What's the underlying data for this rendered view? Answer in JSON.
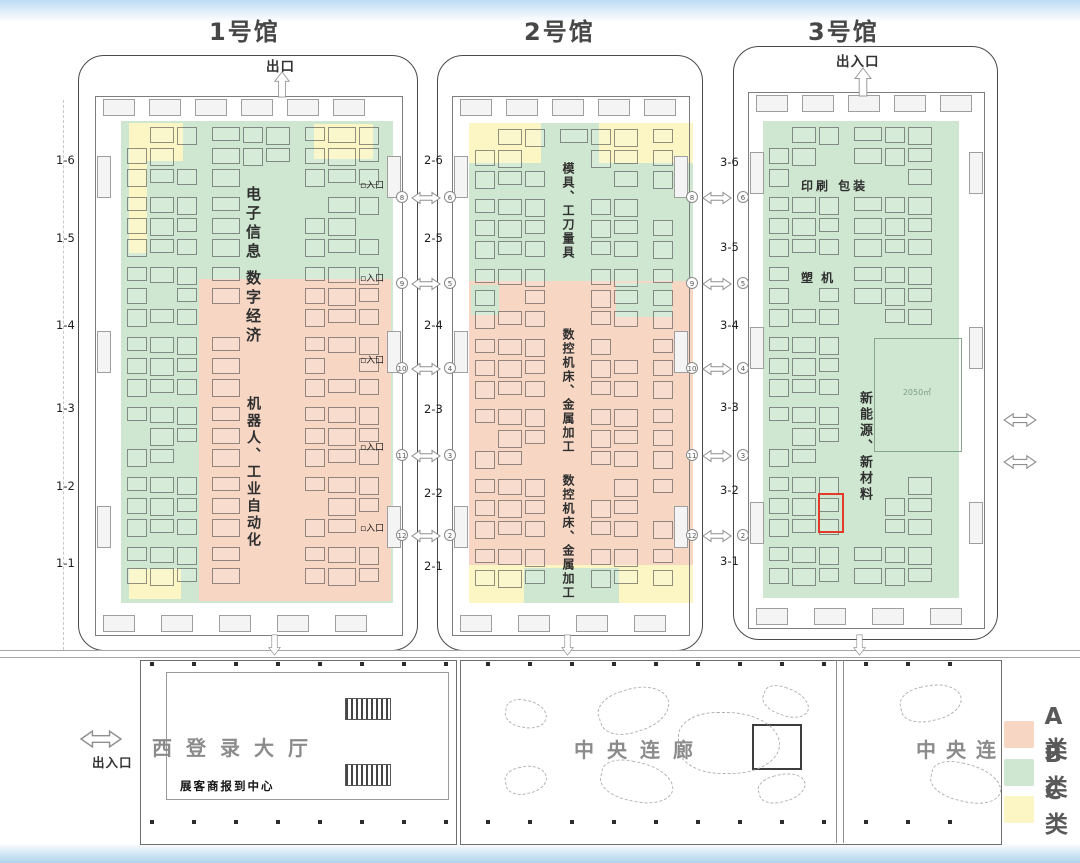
{
  "legend": {
    "items": [
      {
        "label": "A类",
        "color": "#f7d6c4"
      },
      {
        "label": "B类",
        "color": "#cfe7d1"
      },
      {
        "label": "C类",
        "color": "#fbf6c3"
      }
    ]
  },
  "halls": [
    {
      "title": "1号馆",
      "top_exit": "出口",
      "rows": [
        "1-6",
        "1-5",
        "1-4",
        "1-3",
        "1-2",
        "1-1"
      ],
      "zones": {
        "z1": "电子信息",
        "z2": "数字经济",
        "z3": "机器人、工业自动化"
      }
    },
    {
      "title": "2号馆",
      "rows": [
        "2-6",
        "2-5",
        "2-4",
        "2-3",
        "2-2",
        "2-1"
      ],
      "zones": {
        "z1": "模具、工刀量具",
        "z2": "数控机床、金属加工",
        "z3": "数控机床、金属加工"
      }
    },
    {
      "title": "3号馆",
      "top_exit": "出入口",
      "rows": [
        "3-6",
        "3-5",
        "3-4",
        "3-3",
        "3-2",
        "3-1"
      ],
      "zones": {
        "z1": "印刷 包装",
        "z2": "塑 机",
        "z3": "新能源、新材料",
        "area_size": "2050㎡"
      }
    }
  ],
  "gates": {
    "entrance_label": "入口",
    "gap12_left": [
      "8",
      "9",
      "10",
      "11",
      "12"
    ],
    "gap12_right": [
      "6",
      "5",
      "4",
      "3",
      "2"
    ],
    "gap23_left": [
      "8",
      "9",
      "10",
      "11",
      "12"
    ],
    "gap23_right": [
      "6",
      "5",
      "4",
      "3",
      "2"
    ]
  },
  "bottom": {
    "exit": "出入口",
    "west_hall": "西登录大厅",
    "checkin": "展客商报到中心",
    "corridor": "中央连廊",
    "corridor_right": "中央连"
  }
}
